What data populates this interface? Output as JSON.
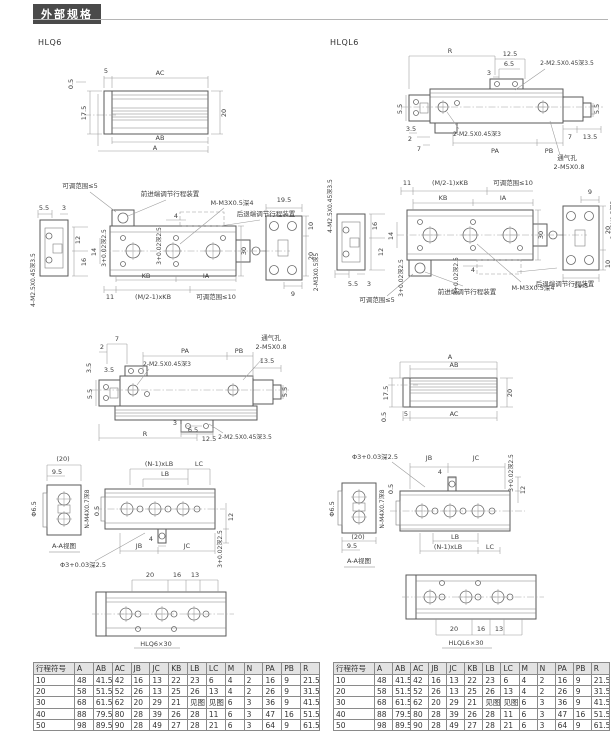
{
  "page": {
    "header": "外部规格"
  },
  "hlq6": {
    "label": "HLQ6",
    "side": {
      "ac": "AC",
      "d5": "5",
      "d05": "0.5",
      "d175": "17.5",
      "d20": "20",
      "ab": "AB",
      "a": "A"
    },
    "top": {
      "adj5": "可调范围≤5",
      "front": "前进端调节行程装置",
      "thread": "M-M3X0.5深4",
      "rear": "后退端调节行程装置",
      "d55": "5.5",
      "d3": "3",
      "d12": "12",
      "d16": "16",
      "screw_side": "4-M2.5X0.45深3.5",
      "d4": "4",
      "tol": "3+0.02深2.5",
      "d14": "14",
      "kb": "KB",
      "ia": "IA",
      "d11": "11",
      "mkb": "(M/2-1)xKB",
      "adj10": "可调范围≤10",
      "d30": "30",
      "d195": "19.5",
      "d10": "10",
      "d20": "20",
      "d9": "9",
      "screw_back": "2-M3X0.5深5"
    },
    "front": {
      "d7": "7",
      "d2": "2",
      "d35": "3.5",
      "pa": "PA",
      "pb": "PB",
      "vent": "通气孔",
      "m5": "2-M5X0.8",
      "m25_3": "2-M2.5X0.45深3",
      "d135": "13.5",
      "d55": "5.5",
      "d3": "3",
      "d65": "6.5",
      "d125": "12.5",
      "r": "R",
      "m25_35": "2-M2.5X0.45深3.5"
    },
    "bottom": {
      "d20p": "(20)",
      "d95": "9.5",
      "dia65": "Φ6.5",
      "nm4": "N-M4X0.7深8",
      "aa": "A-A视图",
      "d05": "0.5",
      "nlb": "(N-1)xLB",
      "lb": "LB",
      "lc": "LC",
      "d12": "12",
      "d4": "4",
      "jb": "JB",
      "jc": "JC",
      "tol": "3+0.02深2.5",
      "dia3": "Φ3+0.03深2.5"
    },
    "detail": {
      "d20": "20",
      "d16": "16",
      "d13": "13",
      "caption": "HLQ6×30"
    }
  },
  "hlql6": {
    "label": "HLQL6",
    "side": {
      "a": "A",
      "ab": "AB",
      "d175": "17.5",
      "d20": "20",
      "d05": "0.5",
      "d5": "5",
      "ac": "AC"
    },
    "top": {
      "d11": "11",
      "mkb": "(M/2-1)xKB",
      "adj10": "可调范围≤10",
      "kb": "KB",
      "ia": "IA",
      "d16": "16",
      "d12": "12",
      "screw_side": "4-M2.5X0.45深3.5",
      "d14": "14",
      "d4": "4",
      "tol": "3+0.02深2.5",
      "adj5": "可调范围≤5",
      "front": "前进端调节行程装置",
      "thread": "M-M3X0.5深4",
      "rear": "后退端调节行程装置",
      "d30": "30",
      "d9": "9",
      "d20": "20",
      "d10": "10",
      "d195": "19.5",
      "d55": "5.5",
      "d3": "3",
      "screw_back": "2-M3X0.5深5"
    },
    "front": {
      "r": "R",
      "d125": "12.5",
      "d65": "6.5",
      "d3": "3",
      "m25_35": "2-M2.5X0.45深3.5",
      "d55": "5.5",
      "d35": "3.5",
      "d2": "2",
      "d7": "7",
      "m25_3": "2-M2.5X0.45深3",
      "pa": "PA",
      "pb": "PB",
      "d135": "13.5",
      "vent": "通气孔",
      "m5": "2-M5X0.8"
    },
    "bottom": {
      "dia3": "Φ3+0.03深2.5",
      "jb": "JB",
      "jc": "JC",
      "d4": "4",
      "tol": "3+0.02深2.5",
      "d05": "0.5",
      "d12": "12",
      "lb": "LB",
      "nlb": "(N-1)xLB",
      "lc": "LC",
      "d20p": "(20)",
      "d95": "9.5",
      "nm4": "N-M4X0.7深8",
      "dia65": "Φ6.5",
      "aa": "A-A视图"
    },
    "detail": {
      "d20": "20",
      "d16": "16",
      "d13": "13",
      "caption": "HLQL6×30"
    }
  },
  "tables": {
    "left": {
      "headers": [
        "行程符号",
        "A",
        "AB",
        "AC",
        "JB",
        "JC",
        "KB",
        "LB",
        "LC",
        "M",
        "N",
        "PA",
        "PB",
        "R"
      ],
      "rows": [
        [
          "10",
          "48",
          "41.5",
          "42",
          "16",
          "13",
          "22",
          "23",
          "6",
          "4",
          "2",
          "16",
          "9",
          "21.5"
        ],
        [
          "20",
          "58",
          "51.5",
          "52",
          "26",
          "13",
          "25",
          "26",
          "13",
          "4",
          "2",
          "26",
          "9",
          "31.5"
        ],
        [
          "30",
          "68",
          "61.5",
          "62",
          "20",
          "29",
          "21",
          "见图",
          "见图",
          "6",
          "3",
          "36",
          "9",
          "41.5"
        ],
        [
          "40",
          "88",
          "79.5",
          "80",
          "28",
          "39",
          "26",
          "28",
          "11",
          "6",
          "3",
          "47",
          "16",
          "51.5"
        ],
        [
          "50",
          "98",
          "89.5",
          "90",
          "28",
          "49",
          "27",
          "28",
          "21",
          "6",
          "3",
          "64",
          "9",
          "61.5"
        ]
      ]
    },
    "right": {
      "headers": [
        "行程符号",
        "A",
        "AB",
        "AC",
        "JB",
        "JC",
        "KB",
        "LB",
        "LC",
        "M",
        "N",
        "PA",
        "PB",
        "R"
      ],
      "rows": [
        [
          "10",
          "48",
          "41.5",
          "42",
          "16",
          "13",
          "22",
          "23",
          "6",
          "4",
          "2",
          "16",
          "9",
          "21.5"
        ],
        [
          "20",
          "58",
          "51.5",
          "52",
          "26",
          "13",
          "25",
          "26",
          "13",
          "4",
          "2",
          "26",
          "9",
          "31.5"
        ],
        [
          "30",
          "68",
          "61.5",
          "62",
          "20",
          "29",
          "21",
          "见图",
          "见图",
          "6",
          "3",
          "36",
          "9",
          "41.5"
        ],
        [
          "40",
          "88",
          "79.5",
          "80",
          "28",
          "39",
          "26",
          "28",
          "11",
          "6",
          "3",
          "47",
          "16",
          "51.5"
        ],
        [
          "50",
          "98",
          "89.5",
          "90",
          "28",
          "49",
          "27",
          "28",
          "21",
          "6",
          "3",
          "64",
          "9",
          "61.5"
        ]
      ]
    }
  }
}
